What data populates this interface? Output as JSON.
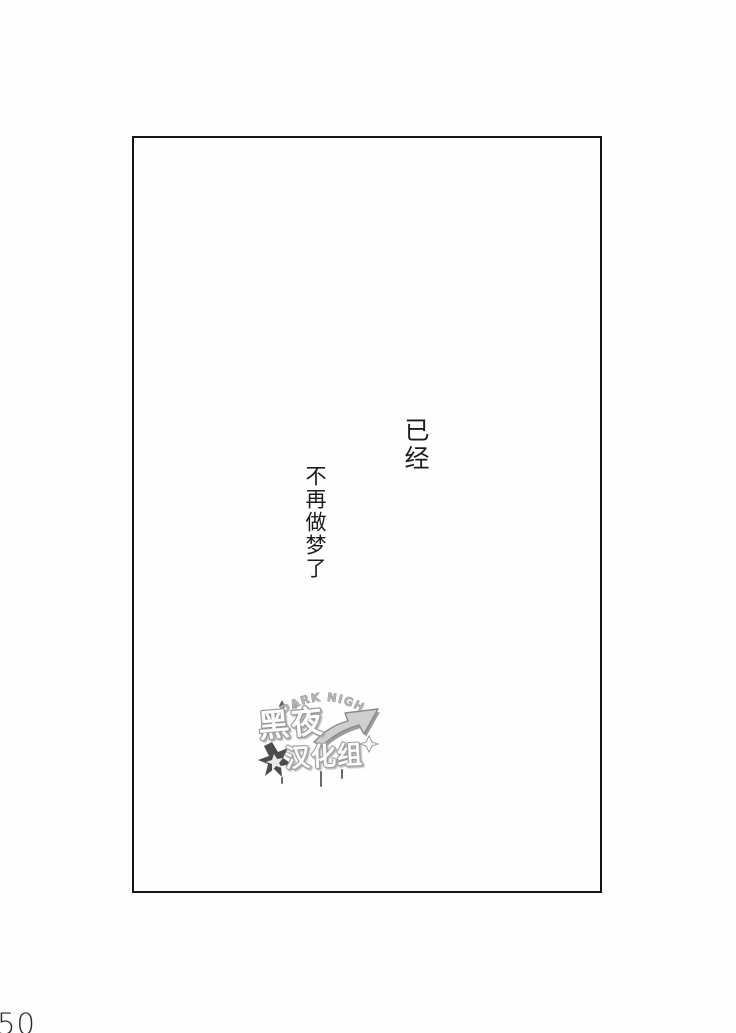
{
  "colors": {
    "background": "#fdfdfd",
    "frame_border": "#151515",
    "dialogue_text": "#1c1c1c",
    "page_number": "#2a2a2a",
    "watermark_outline": "#8f8f8f",
    "watermark_fill": "#ffffff",
    "watermark_dark_accent": "#333333"
  },
  "panel": {
    "dialogue": [
      {
        "text": "已经"
      },
      {
        "text": "不再做梦了"
      }
    ]
  },
  "watermark": {
    "arc_text": "DARK NIGHT",
    "title": "黑夜",
    "subtitle": "汉化组"
  },
  "page": {
    "number": "50"
  }
}
